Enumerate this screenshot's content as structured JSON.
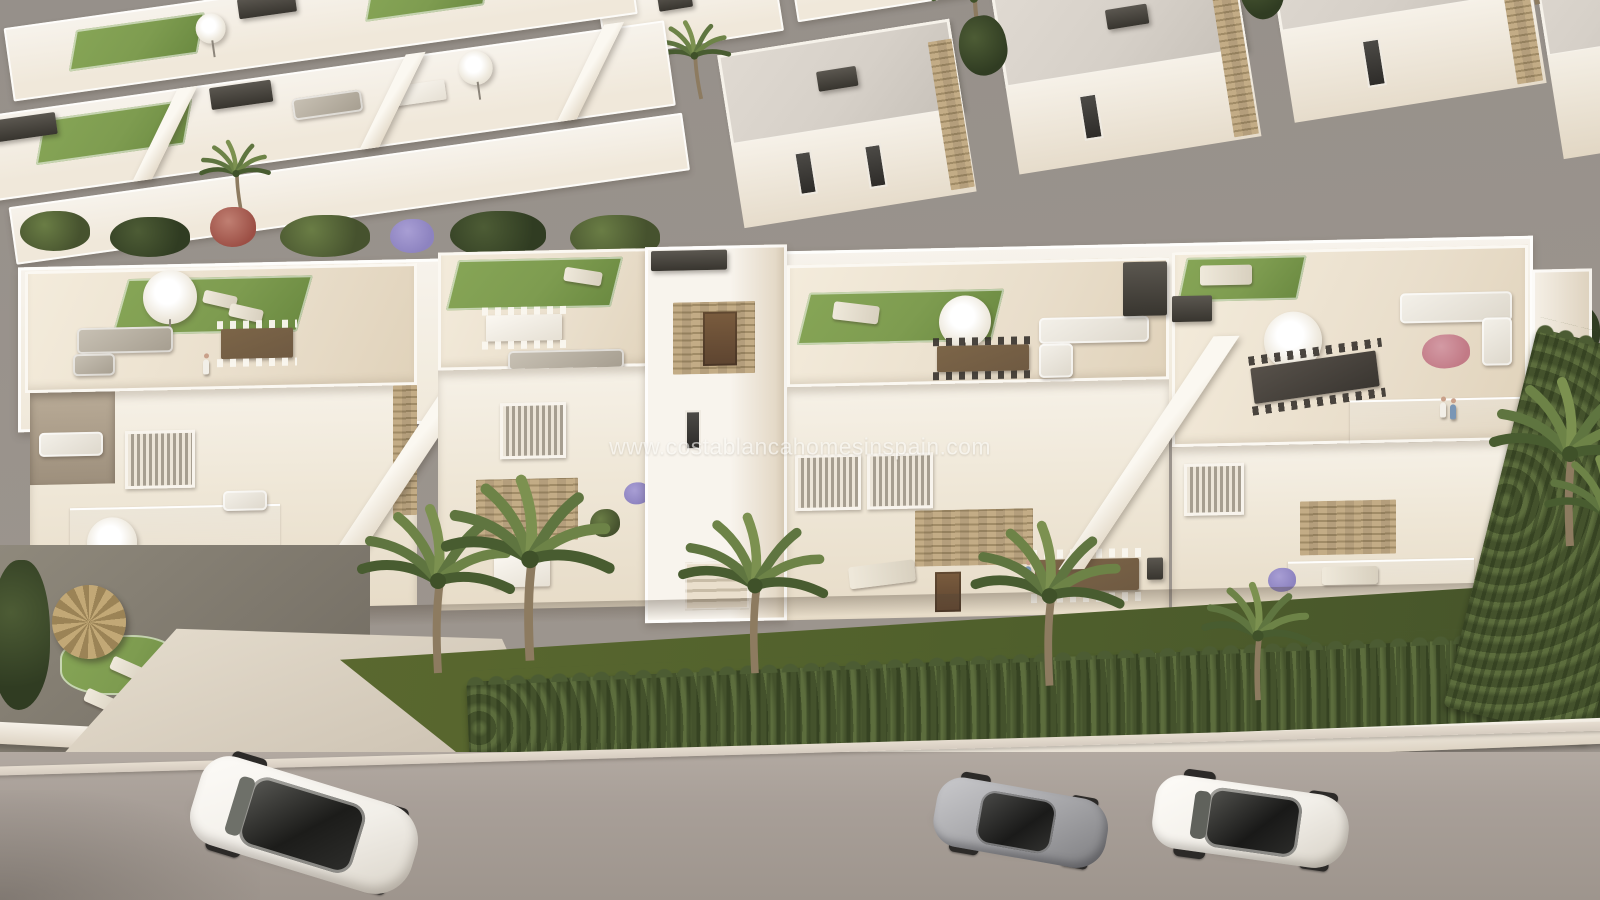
{
  "watermark": {
    "text": "www.costablancahomesinspain.com"
  },
  "scene": {
    "description": "Aerial 3D architectural render of a white Mediterranean townhouse development with rooftop terraces, gardens, palm trees, cypress hedge and a street with three parked cars",
    "sky": "flat warm-gray overcast sky",
    "background": {
      "left": "receding row of white townhouse roof terraces with lawn patches, parasols and dark pergola units",
      "right": "detached white villas with light gravel roofs, stone corner pillars, dark window slits and palm trees"
    },
    "midground": "row of white townhouses with rooftop solariums: artificial lawn, white parasols, grey and white lounge sets, wooden and dark dining tables, stone-clad stair towers and glass-railed terrace with two people",
    "foreground": "private gardens with lawn, cypress hedge row over a white boundary wall, tall palms, thatched palapa with sun loungers and a concrete driveway",
    "street": "asphalt road with light kerb line",
    "cars": [
      {
        "label": "white SUV with black panoramic glass roof",
        "position": "bottom-left"
      },
      {
        "label": "silver sports coupe",
        "position": "bottom-center-right"
      },
      {
        "label": "white sedan with black glass roof",
        "position": "bottom-right"
      }
    ],
    "people": [
      {
        "label": "person in white walking on left rooftop terrace"
      },
      {
        "label": "person standing on centre ground-floor terrace"
      },
      {
        "label": "couple standing at right glass-railed terrace"
      }
    ]
  },
  "palette": {
    "sky": "#96908a",
    "road": "#a89f98",
    "curb": "#d6ccc0",
    "wall": "#f7f3ec",
    "wall-cream": "#f0e8da",
    "wall-shade": "#ddd2c2",
    "tile": "#e9decb",
    "lawn": "#7e9c50",
    "grass-front": "#50602c",
    "hedge": "#44522c",
    "stone": "#c3ac86",
    "unit-dark": "#514d46",
    "wood": "#6f5a42",
    "gravel-roof": "#d6d0c8",
    "glass-dark": "#2b2a29",
    "silver": "#a2a2a5",
    "car-white": "#f2efe9",
    "thatch": "#b49a66",
    "purple": "#8d83c0",
    "pink": "#c27a86",
    "palm": "#5f7540",
    "watermark": "#faf9f6"
  }
}
